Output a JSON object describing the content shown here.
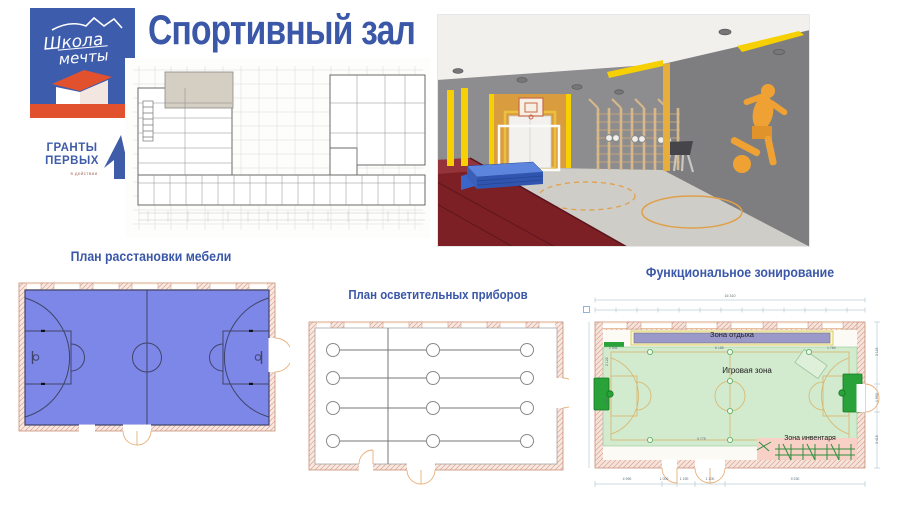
{
  "slide": {
    "title": "Спортивный зал",
    "accent_color": "#3a57a8"
  },
  "logos": {
    "school_flag": {
      "line1": "Школа",
      "line2": "мечты",
      "flag_color": "#3d5cab",
      "base_color": "#e2512e"
    },
    "grants": {
      "line1": "ГРАНТЫ",
      "line2": "ПЕРВЫХ",
      "tagline": "в действии",
      "color": "#3f5ca8"
    }
  },
  "panels": {
    "furniture": {
      "label": "План расстановки мебели",
      "court_color": "#7d87e8"
    },
    "lighting": {
      "label": "План осветительных приборов"
    },
    "zoning": {
      "label": "Функциональное зонирование",
      "zones": [
        {
          "name": "Зона отдыха",
          "color": "#9b99c9"
        },
        {
          "name": "Игровая зона",
          "color": "#cfe9ca"
        },
        {
          "name": "Зона инвентаря",
          "color": "#f8d0c5"
        }
      ],
      "dims": {
        "top_total": "16 310",
        "top_segments": [
          "605",
          "1 900",
          "1 140",
          "1 900",
          "1 140",
          "1 900",
          "1 140",
          "1 900",
          "1 140",
          "1 900",
          "1 140",
          "1 900",
          "605"
        ],
        "bottom": [
          "4 990",
          "1 000",
          "1 190",
          "1 100",
          "9 230"
        ],
        "right": [
          "3 115",
          "1 900",
          "3 415"
        ],
        "inner": {
          "a": "2 541",
          "b": "6 185",
          "c": "1 760",
          "d": "2 122",
          "e": "2 645",
          "f": "9 775"
        }
      }
    }
  }
}
